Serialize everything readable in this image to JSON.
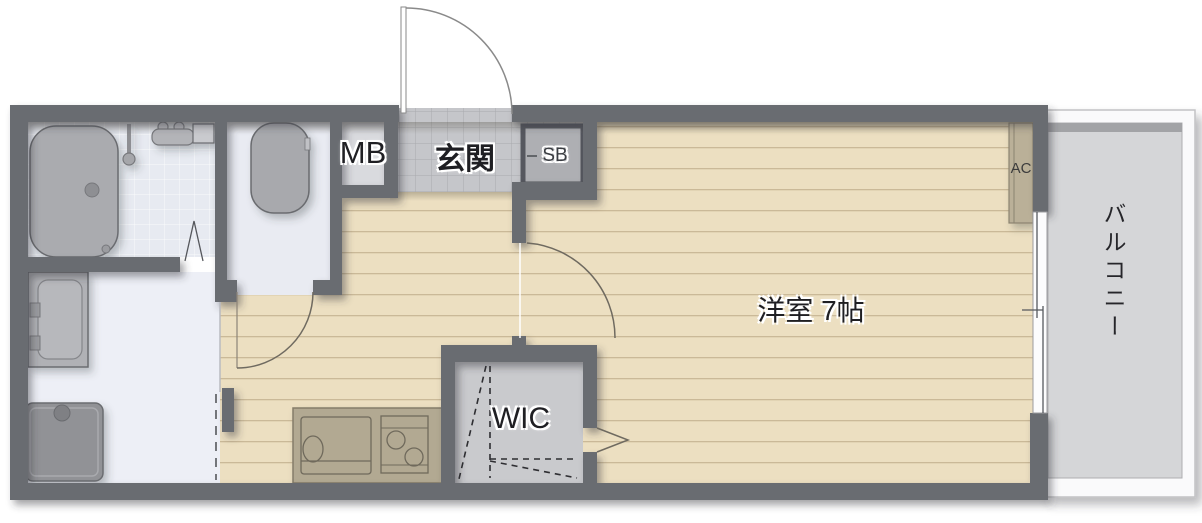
{
  "plan": {
    "labels": {
      "entrance": "玄関",
      "meter_box": "MB",
      "shoe_box": "SB",
      "western_room": "洋室 7帖",
      "wic": "WIC",
      "air_conditioner": "AC",
      "balcony": "バルコニー"
    },
    "western_room_size_jo": 7,
    "fixtures": [
      "bathtub",
      "shower-head",
      "bath-faucet",
      "mirror-cabinet",
      "toilet",
      "vanity-washbasin",
      "washing-machine-pan",
      "kitchen-counter",
      "kitchen-sink",
      "gas-stove",
      "ac-unit",
      "shoe-box",
      "entrance-door-swing",
      "toilet-door-swing",
      "room-door-swing",
      "bathroom-folding-door",
      "wic-folding-door",
      "sliding-door",
      "balcony-sliding-window"
    ],
    "colors": {
      "wall": "#696c71",
      "wood_floor": "#ecdfc1",
      "plank_line": "#d8c7a4",
      "genkan_tile": "#c5c6ca",
      "bathroom_floor": "#e7eaf1",
      "sanitary_floor": "#edeff6",
      "toilet_floor": "#e9ebf2",
      "wic_floor": "#c9cacd",
      "balcony_floor": "#d5d6d8",
      "fixture_gray": "#aaabaf",
      "counter_tan": "#b2a992",
      "ac_tan": "#bab098",
      "label_halo": "#ffffff",
      "label_text": "#1f1f23"
    }
  }
}
